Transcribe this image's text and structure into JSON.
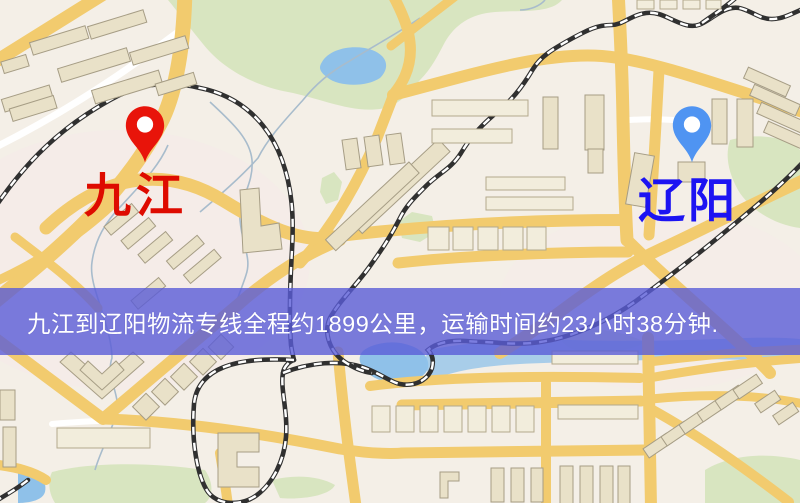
{
  "map": {
    "origin": {
      "label": "九江",
      "pin_color": "#e8140a",
      "label_color": "#de0b00"
    },
    "destination": {
      "label": "辽阳",
      "pin_color": "#4f94f2",
      "label_color": "#1c13f2"
    },
    "banner": {
      "text": "九江到辽阳物流专线全程约1899公里，运输时间约23小时38分钟.",
      "background_color": "#5a5cd7",
      "text_color": "#ffffff"
    },
    "palette": {
      "map_background": "#f4efe7",
      "road_yellow": "#f2cb6e",
      "park_green": "#d8e5c0",
      "water_blue": "#8fc1e9",
      "building_fill": "#e9e1c8",
      "railway_dark": "#303030"
    }
  }
}
